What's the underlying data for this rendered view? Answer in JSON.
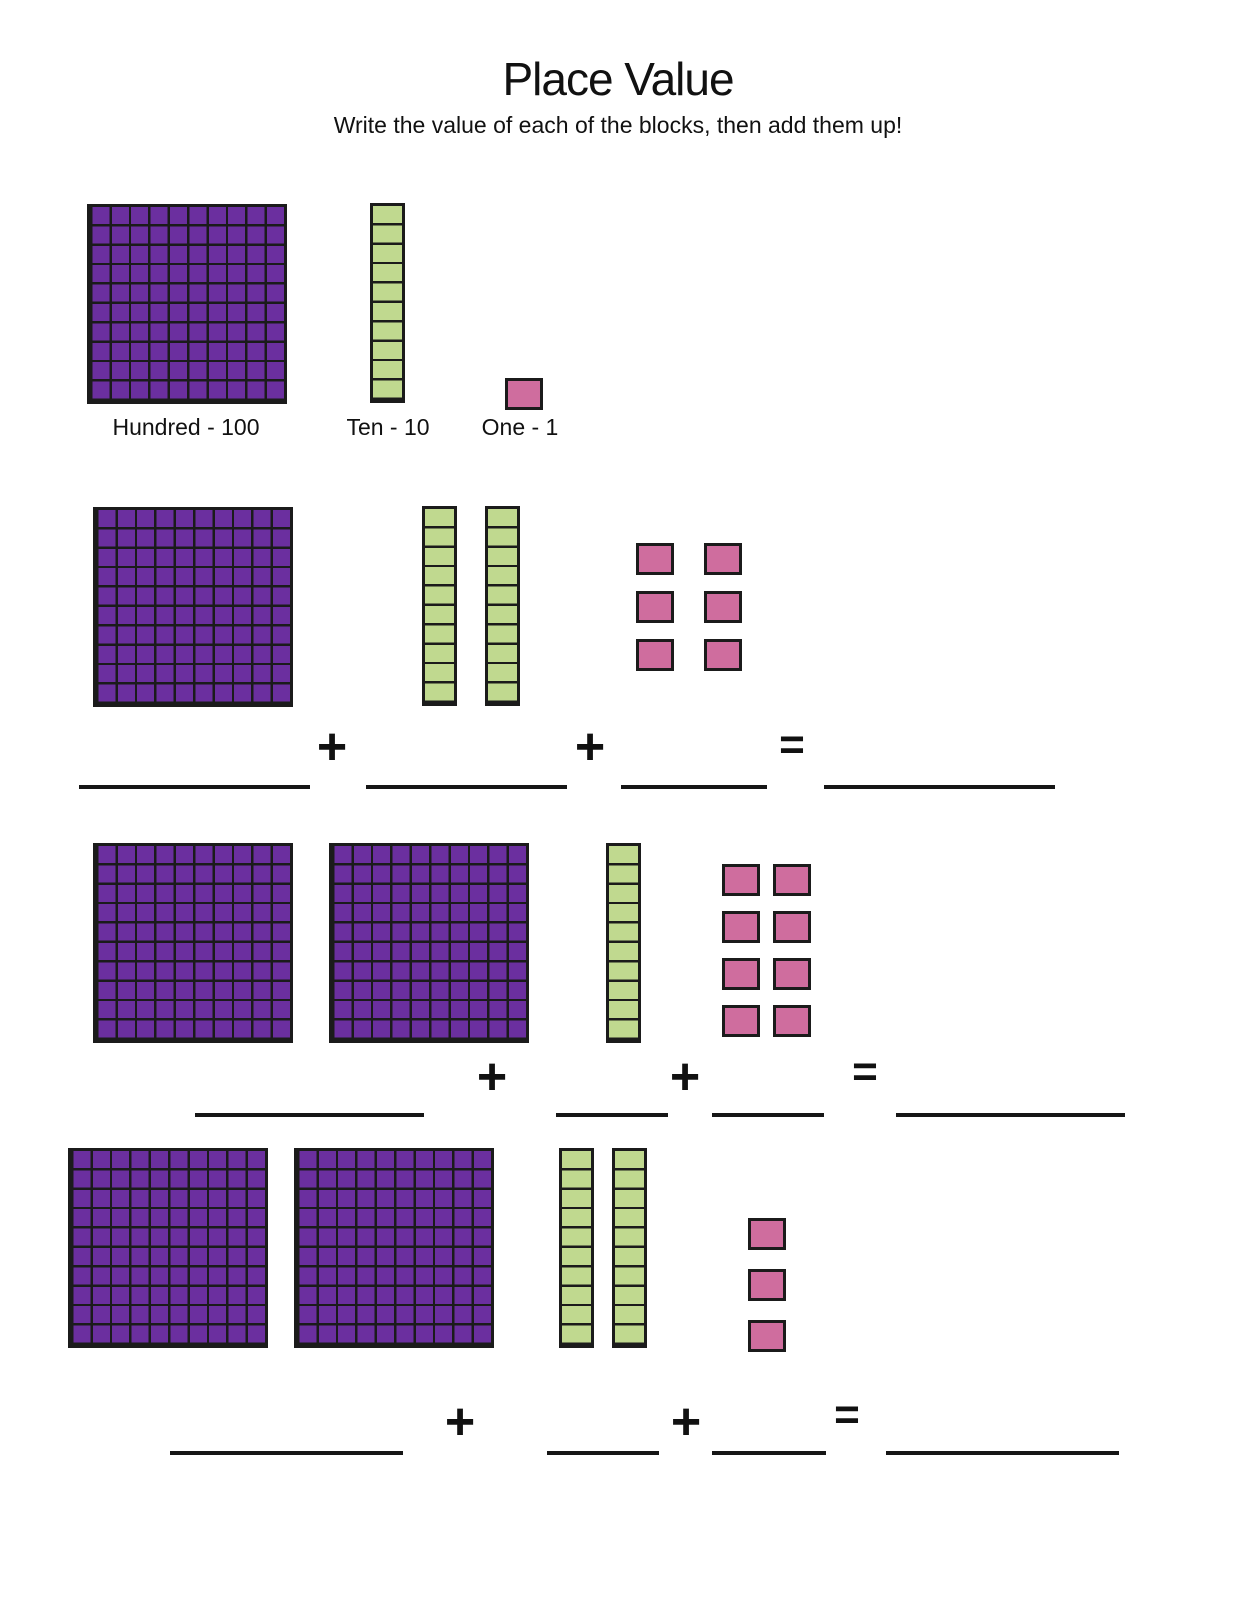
{
  "page": {
    "title": "Place Value",
    "subtitle": "Write the value of each of the blocks, then add them up!"
  },
  "colors": {
    "hundred_fill": "#6b2f9f",
    "ten_fill": "#c0d98f",
    "one_fill": "#cf6d9e",
    "block_line": "#1b1b1b"
  },
  "key": {
    "hundred_label": "Hundred - 100",
    "ten_label": "Ten - 10",
    "one_label": "One - 1",
    "hundred_value": 100,
    "ten_value": 10,
    "one_value": 1
  },
  "operators": {
    "plus": "+",
    "equals": "="
  },
  "problems": [
    {
      "index": 1,
      "hundreds": 1,
      "tens": 2,
      "ones": 6,
      "answer_blanks": 4
    },
    {
      "index": 2,
      "hundreds": 2,
      "tens": 1,
      "ones": 8,
      "answer_blanks": 4
    },
    {
      "index": 3,
      "hundreds": 2,
      "tens": 2,
      "ones": 3,
      "answer_blanks": 4
    }
  ]
}
